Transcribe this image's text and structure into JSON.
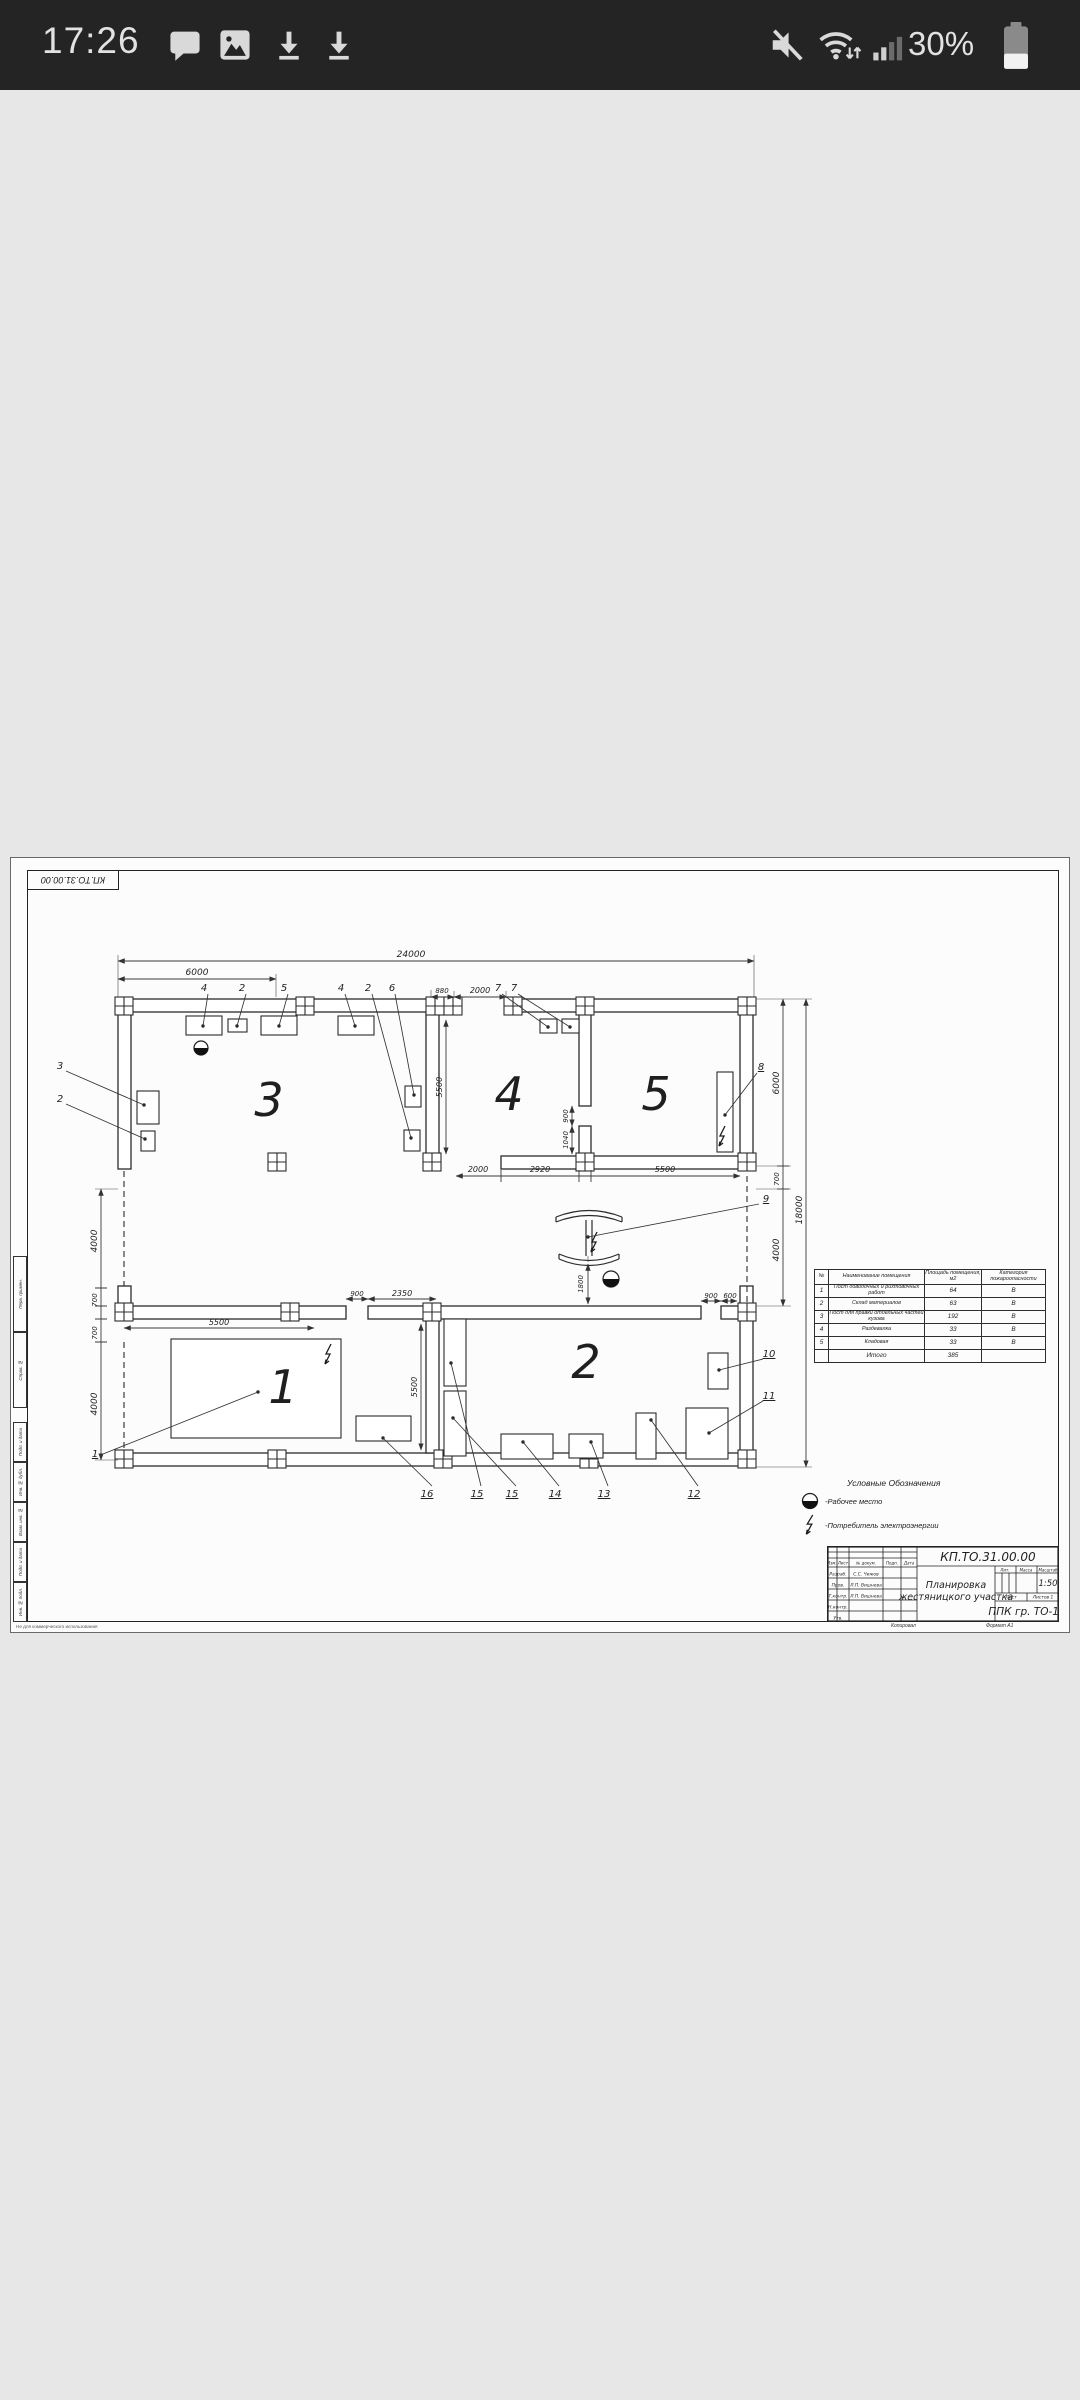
{
  "status_bar": {
    "time": "17:26",
    "battery": "30%",
    "icons": [
      "chat-icon",
      "gallery-icon",
      "download-icon",
      "download-icon",
      "mute-icon",
      "wifi-icon",
      "signal-icon",
      "battery-icon"
    ]
  },
  "sheet": {
    "code": "КП.ТО.31.00.00",
    "watermark": "Не для коммерческого использования",
    "footer": {
      "copied": "Копировал",
      "format": "Формат  А1"
    },
    "side_labels": [
      "Перв. примен.",
      "Справ. №",
      "Подп. и дата",
      "Инв. № дубл.",
      "Взам. инв. №",
      "Подп. и дата",
      "Инв. № подл."
    ],
    "legend": {
      "title": "Условные Обозначения",
      "worker": "-Рабочее место",
      "consumer": "-Потребитель электроэнергии"
    },
    "rooms_table": {
      "headers": [
        "№",
        "Наименование помещения",
        "Площадь помещения, м2",
        "Категория пожароопасности"
      ],
      "rows": [
        {
          "n": "1",
          "name": "Пост доводочных и рихтовочных работ",
          "area": "64",
          "cat": "В"
        },
        {
          "n": "2",
          "name": "Склад материалов",
          "area": "63",
          "cat": "В"
        },
        {
          "n": "3",
          "name": "Пост для правки отдельных частей кузова",
          "area": "192",
          "cat": "В"
        },
        {
          "n": "4",
          "name": "Раздевалка",
          "area": "33",
          "cat": "В"
        },
        {
          "n": "5",
          "name": "Кладовая",
          "area": "33",
          "cat": "В"
        }
      ],
      "total_label": "Итого",
      "total_area": "385"
    },
    "title_block": {
      "doc": "КП.ТО.31.00.00",
      "title1": "Планировка",
      "title2": "жестяницкого участка",
      "cols": [
        "Изм.",
        "Лист",
        "№ докум.",
        "Подп.",
        "Дата"
      ],
      "rows": [
        {
          "r": "Разраб.",
          "n": "С.С. Чижов"
        },
        {
          "r": "Пров.",
          "n": "Л.П. Вишнева"
        },
        {
          "r": "Т.контр.",
          "n": "Л.П. Вишнева"
        },
        {
          "r": "Н.контр.",
          "n": ""
        },
        {
          "r": "Утв.",
          "n": ""
        }
      ],
      "lit": "Лит.",
      "mass": "Масса",
      "scale_l": "Масштаб",
      "scale": "1:50",
      "sheet_l": "Лист",
      "sheets_l": "Листов 1",
      "org": "ППК гр. ТО-18"
    },
    "plan": {
      "rooms": {
        "r1": "1",
        "r2": "2",
        "r3": "3",
        "r4": "4",
        "r5": "5"
      },
      "dims": {
        "top": "24000",
        "top6": "6000",
        "d880": "880",
        "d2000": "2000",
        "a2000": "2000",
        "a2920": "2920",
        "a5500": "5500",
        "b5500": "5500",
        "b900": "900",
        "b2350": "2350",
        "b900r": "900",
        "b600": "600",
        "v5500t": "5500",
        "v5500b": "5500",
        "v900": "900",
        "v1040": "1040",
        "v1800": "1800",
        "r6000": "6000",
        "r700": "700",
        "r4000": "4000",
        "r18000": "18000",
        "l4000a": "4000",
        "l700a": "700",
        "l700b": "700",
        "l4000b": "4000"
      },
      "callouts": {
        "t1": "4",
        "t2": "2",
        "t3": "5",
        "t4": "4",
        "t5": "2",
        "t6": "6",
        "t7": "7",
        "t8": "7",
        "l3": "3",
        "l2": "2",
        "e8": "8",
        "e9": "9",
        "r10": "10",
        "r11": "11",
        "c1": "1",
        "b16": "16",
        "b15a": "15",
        "b15b": "15",
        "b14": "14",
        "b13": "13",
        "b12": "12"
      }
    }
  }
}
